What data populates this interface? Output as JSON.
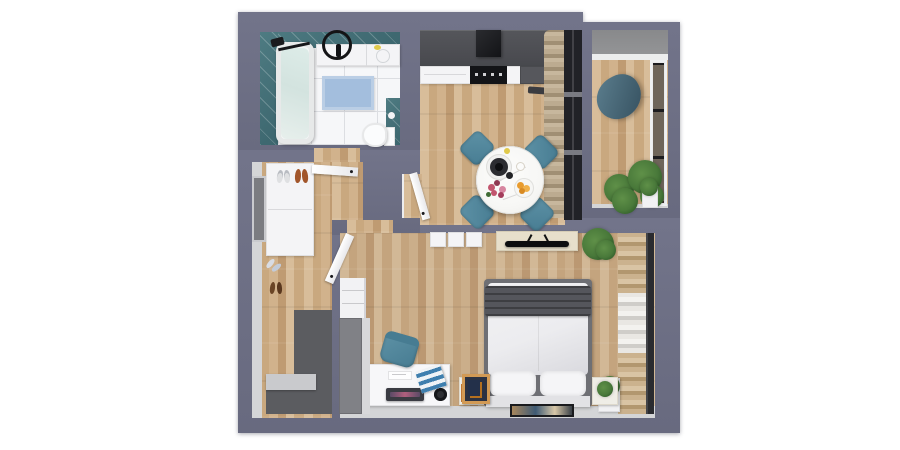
{
  "scene": {
    "description": "3D top-down rendered floor plan of a one-bedroom apartment on white background",
    "rooms": [
      {
        "name": "bathroom",
        "position": "top-left",
        "features": [
          "teal wall tiles",
          "white tile floor",
          "bathtub",
          "black shower fixture",
          "sink vanity with black round mirror ring",
          "washing area",
          "toilet",
          "light-blue bath mat"
        ]
      },
      {
        "name": "kitchen-dining",
        "position": "top-center",
        "features": [
          "dark gray counter with black cooktop and hood",
          "white drawer fronts",
          "round white marble dining table",
          "four teal chairs",
          "table setting with bowl, flowers and fruit",
          "beige curtain",
          "dark glazed wall to balcony"
        ]
      },
      {
        "name": "balcony",
        "position": "top-right",
        "features": [
          "gray glass panel",
          "dark-teal lounge chair",
          "potted green plants",
          "white planter box",
          "glazed side wall"
        ]
      },
      {
        "name": "entry-hall",
        "position": "left",
        "features": [
          "white wardrobe with shoes on top",
          "shoes on floor",
          "entry door recess",
          "dark entry mat zone",
          "gray step",
          "open white door"
        ]
      },
      {
        "name": "living-bedroom",
        "position": "bottom",
        "features": [
          "double bed with white duvet and dark gray throw",
          "two pillows",
          "two nightstands",
          "wall art at bed head",
          "TV on light sideboard",
          "white storage boxes",
          "potted plants",
          "open wardrobe with folded clothes and dark rail",
          "white desk with laptop, papers and magazines",
          "teal desk chair",
          "leaning picture frame",
          "tall gray wardrobe",
          "open white shelving unit",
          "open white door"
        ]
      }
    ]
  },
  "colors": {
    "wall": "#686a7f",
    "wallHi": "#72748a",
    "face": "#d4d5d7",
    "faceDark": "#7b7c81",
    "wood1": "#d8bd9a",
    "wood2": "#c9a87f",
    "wood3": "#bf9b72",
    "wood4": "#d1b28c",
    "bathFloor": "#f6f7f9",
    "tileLine": "#dcdee2",
    "tealTile": "#4e7b82",
    "tealTileDark": "#3c666e",
    "tub": "#f4f6f6",
    "tubWater": "#dde9e6",
    "mat": "#a3bedd",
    "counter": "#47484d",
    "counterDark": "#56575c",
    "stove": "#131417",
    "white": "#f4f4f6",
    "tableTop": "#f7f7f5",
    "chairTeal": "#5e92a6",
    "chairTealDark": "#477c92",
    "curtain1": "#c7b79d",
    "curtain2": "#a08f74",
    "frameDark": "#212227",
    "glass": "#939496",
    "pane": "#6e655a",
    "plantDark": "#2f5a29",
    "plant": "#49793a",
    "plantLight": "#5f9048",
    "duvet": "#ececef",
    "duvetShade": "#d9d9de",
    "blanket": "#55565c",
    "pillow": "#f5f5f7",
    "bedBase": "#e2e2e5",
    "bedFrame": "#6e6f74",
    "cream": "#efede6",
    "tv": "#0c0d10",
    "console": "#e7dfcb",
    "desk": "#f7f7f9",
    "laptop": "#3a3b42",
    "laptopGlow": "#b05f7d",
    "magazine": "#3f7fae",
    "wardrobeGray": "#808186",
    "wardrobeLight": "#d8d8da",
    "clothesTan1": "#cbb28e",
    "clothesTan2": "#b2976f",
    "clothesWhite": "#e9e7e3",
    "clothesGray": "#cfcdc9",
    "rail": "#2a2b2f",
    "entryDark": "#5b5c60",
    "step": "#c9cacd",
    "shoeOrange": "#a2562b",
    "shoeBrown": "#6b4526",
    "shoeWhite": "#dfe0e2",
    "planter": "#f1f1f3",
    "frameTan": "#d29a55",
    "frameInner": "#2c3242",
    "flower": "#c2556e",
    "fruit": "#e89b2e",
    "lemon": "#e0c94b"
  }
}
